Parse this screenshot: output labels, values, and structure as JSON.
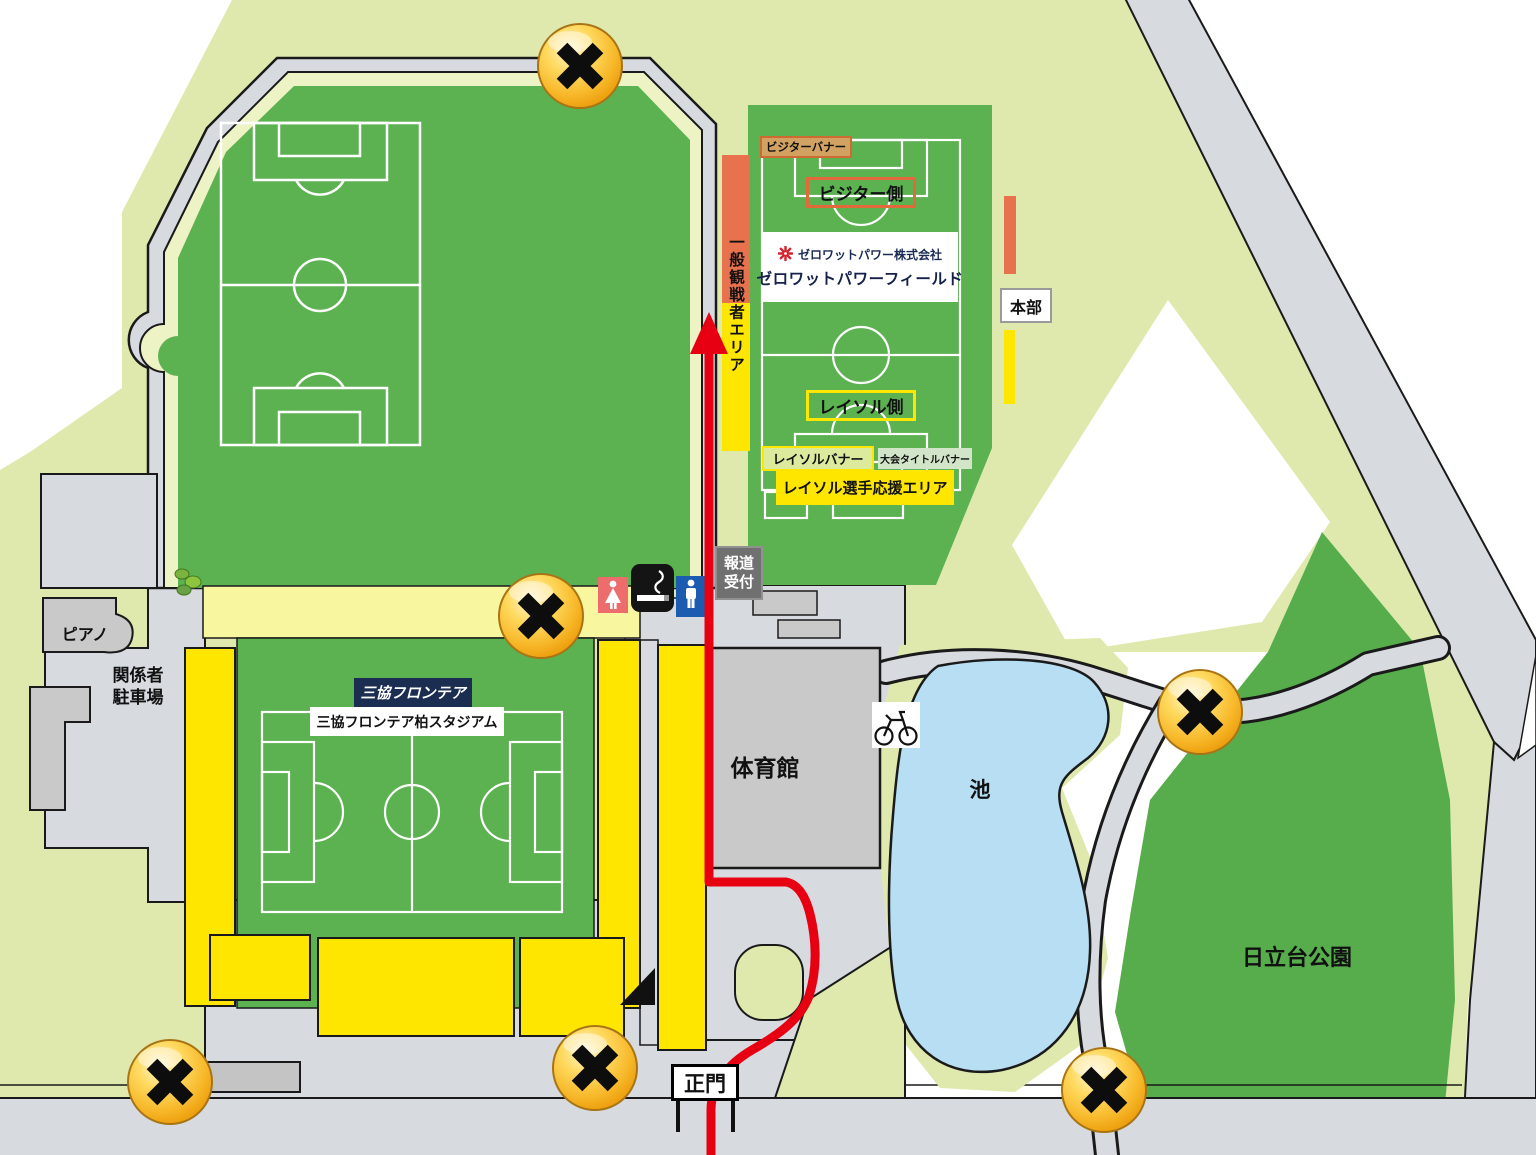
{
  "map_labels": {
    "practice_field": {
      "visitor_banner": "ビジターバナー",
      "visitor_side": "ビジター側",
      "company_name": "ゼロワットパワー株式会社",
      "field_name": "ゼロワットパワーフィールド",
      "reysol_side": "レイソル側",
      "reysol_banner": "レイソルバナー",
      "tournament_title_banner": "大会タイトルバナー",
      "reysol_player_support_area": "レイソル選手応援エリア",
      "general_spectator_area": "一般観戦者エリア",
      "headquarters": "本部",
      "press_reception_line1": "報道",
      "press_reception_line2": "受付"
    },
    "stadium": {
      "sponsor_logo": "三協フロンテア",
      "stadium_name": "三協フロンテア柏スタジアム"
    },
    "facilities": {
      "piano": "ピアノ",
      "staff_parking_line1": "関係者",
      "staff_parking_line2": "駐車場",
      "gymnasium": "体育館",
      "pond": "池",
      "park": "日立台公園",
      "main_gate": "正門"
    }
  },
  "icons": {
    "closed_gate_marker": "gold-circle-black-x",
    "female_toilet": "woman-pictogram-red",
    "male_toilet": "man-pictogram-blue",
    "smoking_area": "cigarette-black",
    "bicycle_parking": "bicycle",
    "route_arrow": "red-arrow-up",
    "company_emblem": "red-flower-asterisk",
    "plant": "bush"
  },
  "colors": {
    "field_green": "#5cb150",
    "park_green": "#57ad4c",
    "land_light_green": "#dfe9ad",
    "ring_cream": "#eef3c6",
    "road_gray": "#d7dbe0",
    "building_gray": "#c9c9c9",
    "stand_yellow": "#ffe600",
    "pale_yellow": "#f8f7a0",
    "area_orange": "#e8724d",
    "route_red": "#e60012",
    "pond_blue": "#b7def2",
    "marker_gold": "#f5b921",
    "navy": "#1b2d50"
  }
}
